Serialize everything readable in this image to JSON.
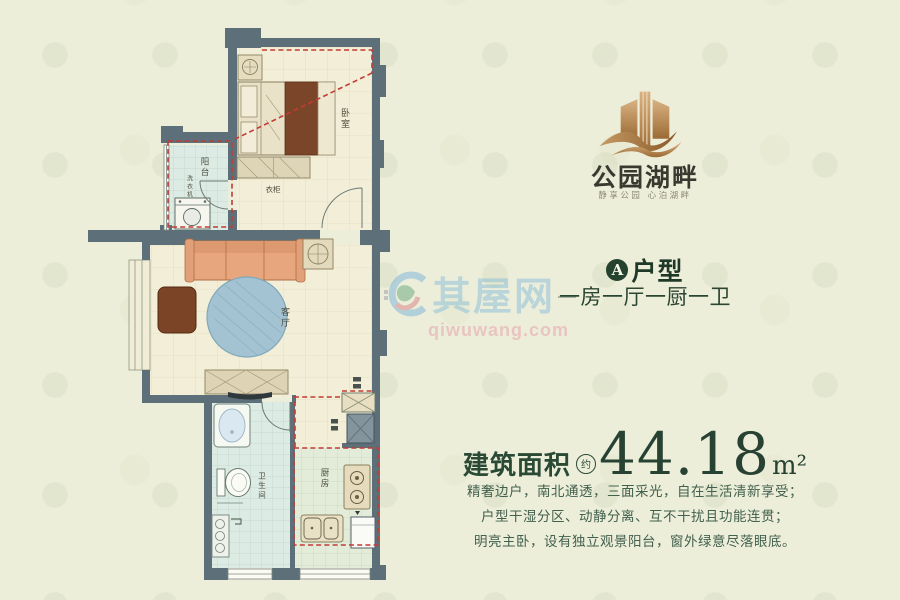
{
  "brand": {
    "name": "公园湖畔",
    "tagline": "静享公园  心泊湖畔"
  },
  "unit": {
    "badge": "A",
    "type": "户型",
    "layout": "一房一厅一厨一卫"
  },
  "area": {
    "label": "建筑面积",
    "approx": "约",
    "value": "44.18",
    "unit": "m²"
  },
  "description": {
    "line1": "精奢边户，南北通透，三面采光，自在生活清新享受；",
    "line2": "户型干湿分区、动静分离、互不干扰且功能连贯；",
    "line3": "明亮主卧，设有独立观景阳台，窗外绿意尽落眼底。"
  },
  "watermark": {
    "name": "其屋网",
    "url": "qiwuwang.com"
  },
  "floorplan": {
    "rooms": {
      "bedroom": "卧室",
      "living": "客厅",
      "balcony": "阳台",
      "bathroom": "卫生间",
      "kitchen": "厨房",
      "wardrobe": "衣柜",
      "washer": "洗衣机"
    }
  },
  "colors": {
    "accent_green": "#2a4a36",
    "gold": "#b8864f",
    "wall": "#5d7079",
    "red_dash": "#c23b35",
    "floor_cream": "#f3eed7",
    "floor_teal": "#dcebe3",
    "floor_green": "#e3ecd8"
  }
}
